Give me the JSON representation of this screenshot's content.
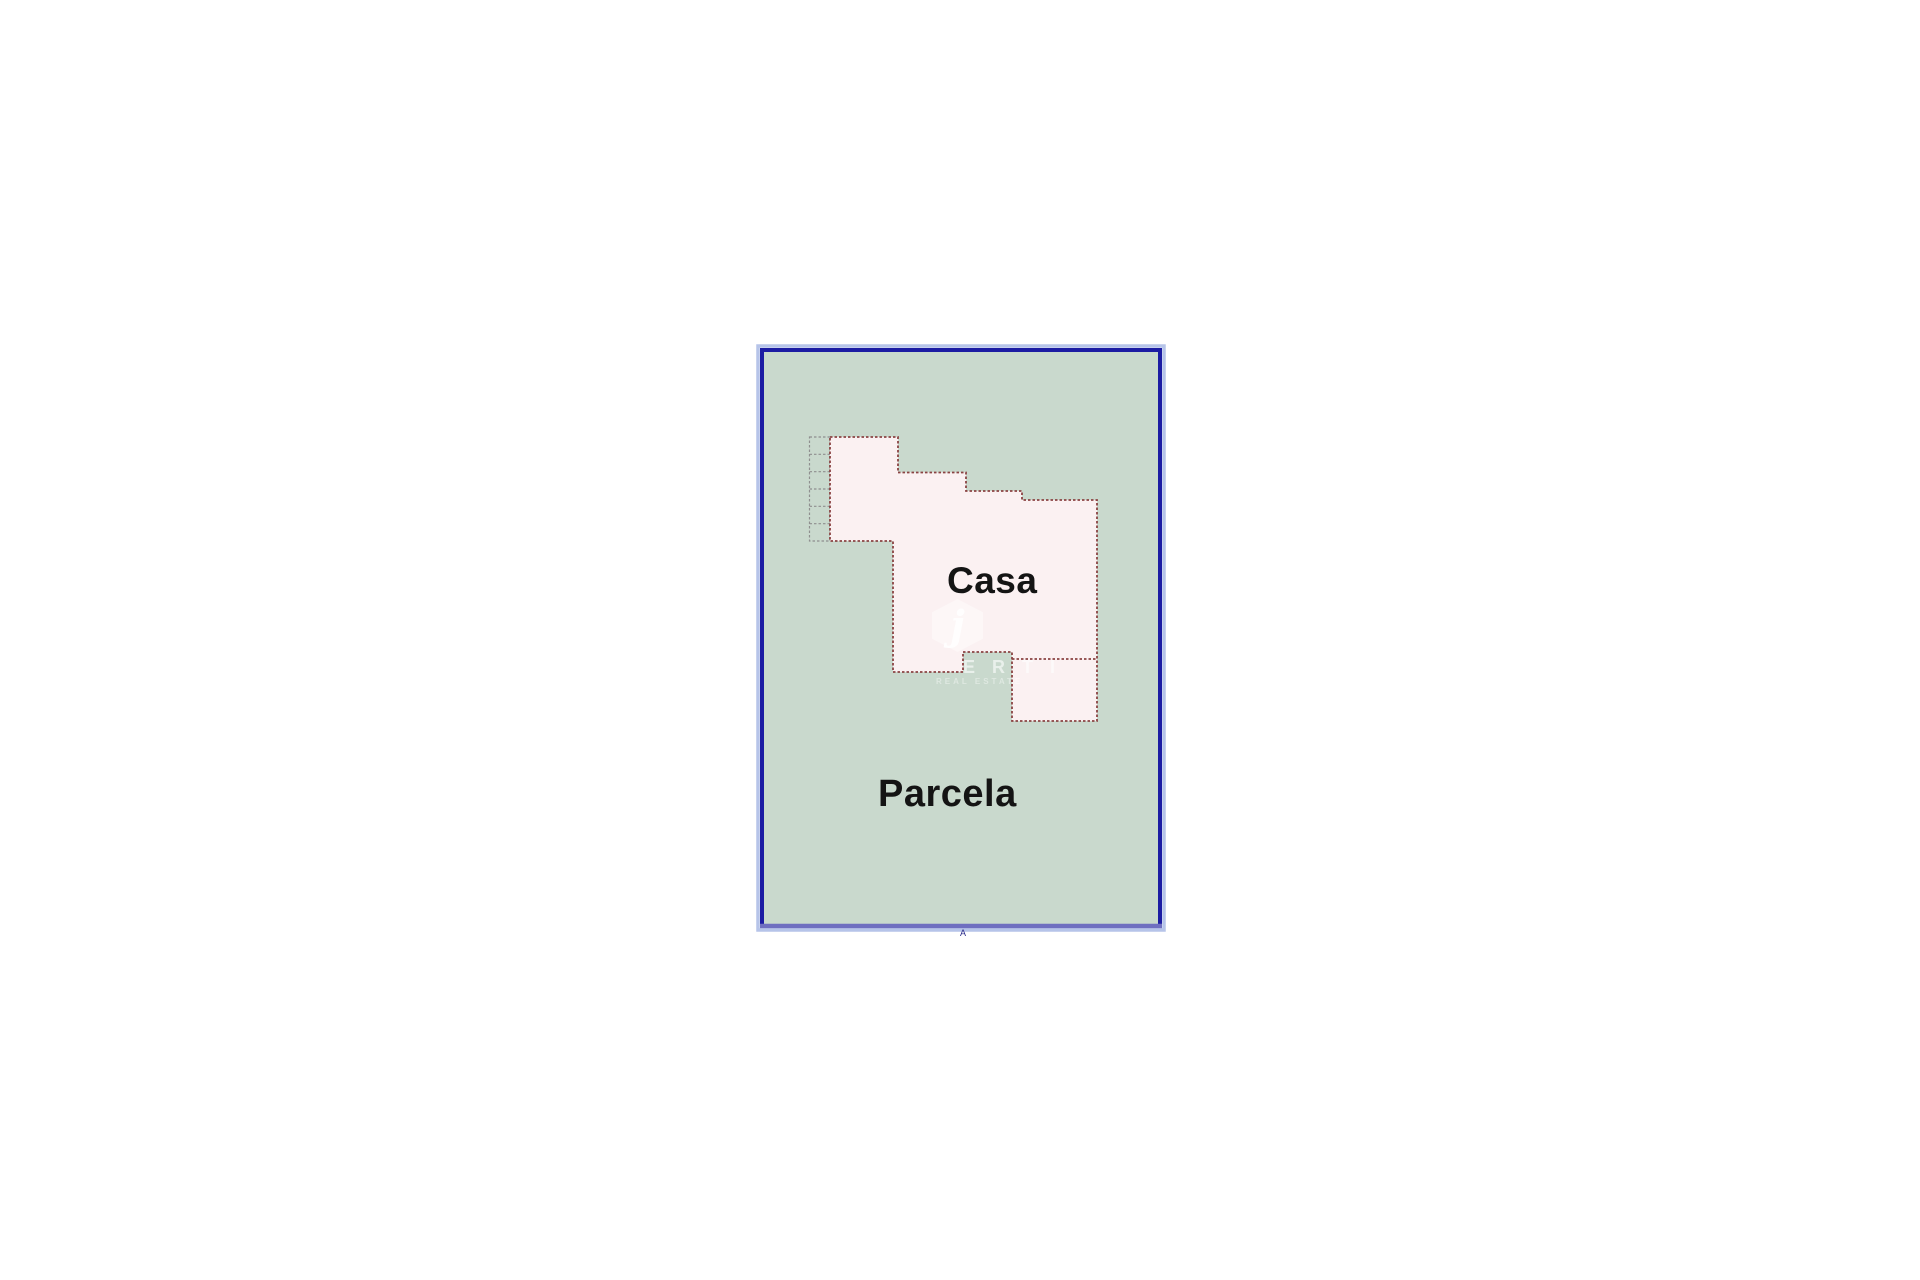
{
  "plan": {
    "house_label": "Casa",
    "parcel_label": "Parcela",
    "corner_mark": "A",
    "watermark": {
      "logo_letter": "j",
      "text": "E R T I",
      "subtext": "REAL ESTATE"
    },
    "colors": {
      "canvas_bg": "#ffffff",
      "parcel_fill": "#c9d9cd",
      "parcel_border": "#1c1ca3",
      "parcel_border_glow": "#b6c4e9",
      "parcel_border_bottom": "#6f6fc0",
      "house_fill": "#fbf1f2",
      "house_outline": "#8b4343",
      "steps_line": "#8f8f8f",
      "label_color": "#141414",
      "corner_mark_color": "#2a2a8a"
    }
  }
}
